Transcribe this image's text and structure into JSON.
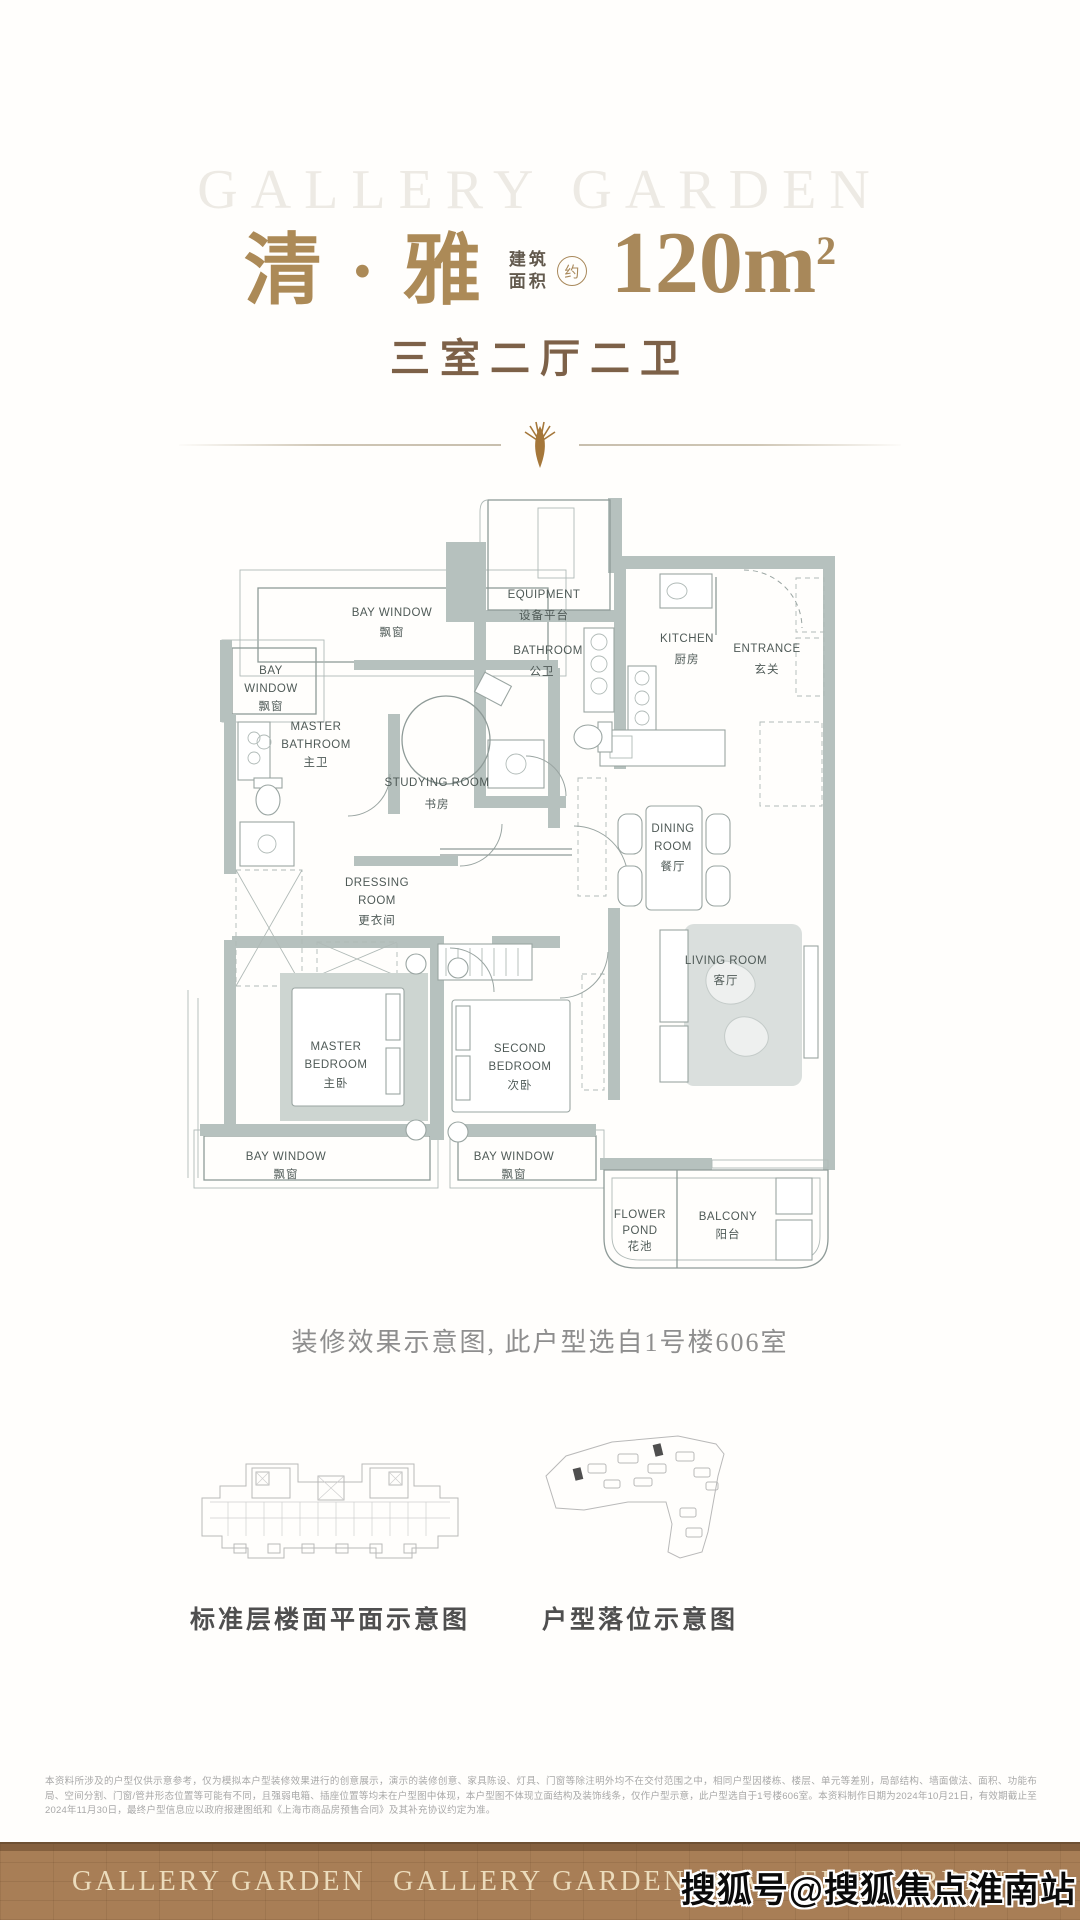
{
  "colors": {
    "accent_gold": "#ab8a58",
    "subtitle_brown": "#7d6148",
    "wall_gray": "#b6c1be",
    "footer_brown": "#a87e56"
  },
  "header": {
    "watermark": "GALLERY GARDEN",
    "title": "清 · 雅",
    "area_label_top": "建筑",
    "area_label_bottom": "面积",
    "area_badge": "约",
    "area_value": "120m",
    "area_sup": "2",
    "subtitle": "三室二厅二卫"
  },
  "floor_plan": {
    "rooms": [
      {
        "id": "bay-window-top",
        "lines": [
          "BAY WINDOW",
          "飘窗"
        ]
      },
      {
        "id": "equipment",
        "lines": [
          "EQUIPMENT",
          "设备平台"
        ]
      },
      {
        "id": "bathroom-public",
        "lines": [
          "BATHROOM",
          "公卫"
        ]
      },
      {
        "id": "kitchen",
        "lines": [
          "KITCHEN",
          "厨房"
        ]
      },
      {
        "id": "entrance",
        "lines": [
          "ENTRANCE",
          "玄关"
        ]
      },
      {
        "id": "bay-window-left",
        "lines": [
          "BAY",
          "WINDOW",
          "飘窗"
        ]
      },
      {
        "id": "master-bathroom",
        "lines": [
          "MASTER",
          "BATHROOM",
          "主卫"
        ]
      },
      {
        "id": "studying-room",
        "lines": [
          "STUDYING ROOM",
          "书房"
        ]
      },
      {
        "id": "dressing-room",
        "lines": [
          "DRESSING",
          "ROOM",
          "更衣间"
        ]
      },
      {
        "id": "dining-room",
        "lines": [
          "DINING",
          "ROOM",
          "餐厅"
        ]
      },
      {
        "id": "living-room",
        "lines": [
          "LIVING ROOM",
          "客厅"
        ]
      },
      {
        "id": "master-bedroom",
        "lines": [
          "MASTER",
          "BEDROOM",
          "主卧"
        ]
      },
      {
        "id": "second-bedroom",
        "lines": [
          "SECOND",
          "BEDROOM",
          "次卧"
        ]
      },
      {
        "id": "bay-window-bottom-left",
        "lines": [
          "BAY WINDOW",
          "飘窗"
        ]
      },
      {
        "id": "bay-window-bottom-mid",
        "lines": [
          "BAY WINDOW",
          "飘窗"
        ]
      },
      {
        "id": "flower-pond",
        "lines": [
          "FLOWER",
          "POND",
          "花池"
        ]
      },
      {
        "id": "balcony",
        "lines": [
          "BALCONY",
          "阳台"
        ]
      }
    ]
  },
  "main_caption": "装修效果示意图, 此户型选自1号楼606室",
  "diagrams": {
    "left_caption": "标准层楼面平面示意图",
    "right_caption": "户型落位示意图"
  },
  "disclaimer": {
    "text": "本资料所涉及的户型仅供示意参考，仅为模拟本户型装修效果进行的创意展示，演示的装修创意、家具陈设、灯具、门窗等除注明外均不在交付范围之中，相同户型因楼栋、楼层、单元等差别，局部结构、墙面做法、面积、功能布局、空间分割、门窗/管井形态位置等可能有不同，且强弱电箱、插座位置等均未在户型图中体现，本户型图不体现立面结构及装饰线条，仅作户型示意，此户型选自于1号楼606室。本资料制作日期为2024年10月21日，有效期截止至2024年11月30日，最终户型信息应以政府报建图纸和《上海市商品房预售合同》及其补充协议约定为准。"
  },
  "footer": {
    "brand": "GALLERY GARDEN"
  },
  "overlay_watermark": "搜狐号@搜狐焦点淮南站"
}
